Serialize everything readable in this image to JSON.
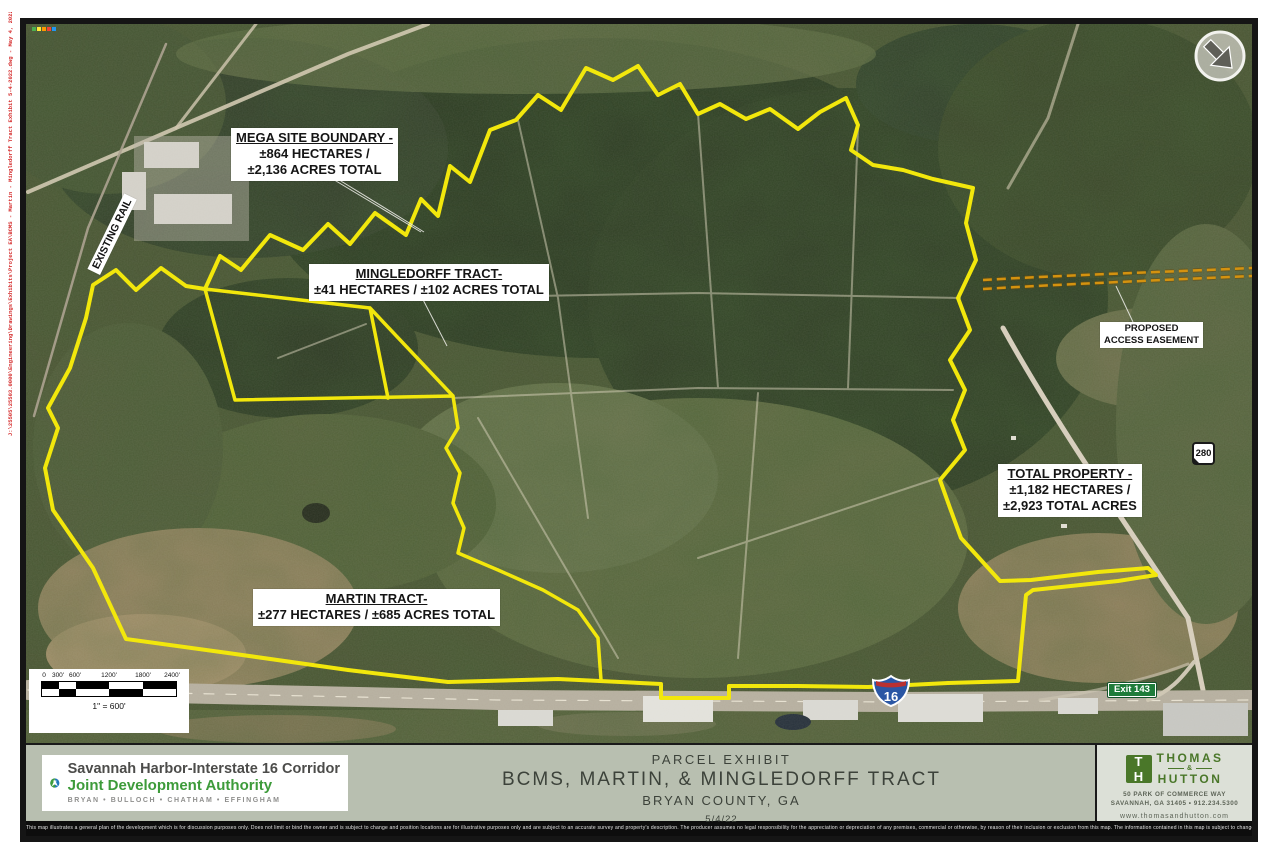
{
  "sheet": {
    "plot_stamp": "J:\\25505\\25503.0000\\Engineering\\Drawings\\Exhibits\\Project EA\\BCMS - Martin - Mingledorff Tract Exhibit 5-4-2022.dwg - May 4, 2022 - 2:36:06 PM"
  },
  "map": {
    "labels": {
      "mega_site": {
        "title": "MEGA SITE BOUNDARY -",
        "line1": "±864 HECTARES /",
        "line2": "±2,136 ACRES TOTAL"
      },
      "mingledorff": {
        "title": "MINGLEDORFF TRACT-",
        "line1": "±41 HECTARES / ±102 ACRES TOTAL"
      },
      "martin": {
        "title": "MARTIN TRACT-",
        "line1": "±277 HECTARES / ±685 ACRES TOTAL"
      },
      "total_property": {
        "title": "TOTAL PROPERTY -",
        "line1": "±1,182 HECTARES /",
        "line2": "±2,923 TOTAL ACRES"
      },
      "access_easement": {
        "line1": "PROPOSED",
        "line2": "ACCESS EASEMENT"
      },
      "existing_rail": "EXISTING RAIL"
    },
    "markers": {
      "interstate": "16",
      "state_route": "280",
      "exit_sign": "Exit 143"
    },
    "scale_bar": {
      "ticks": [
        "0",
        "300'",
        "600'",
        "1200'",
        "1800'",
        "2400'"
      ],
      "ratio": "1\" = 600'"
    },
    "colors": {
      "boundary_yellow": "#f2e70c",
      "easement_orange": "#d4920f"
    }
  },
  "title_block": {
    "project": {
      "type": "PARCEL EXHIBIT",
      "name": "BCMS, MARTIN, & MINGLEDORFF TRACT",
      "location": "BRYAN COUNTY, GA",
      "date": "5/4/22"
    },
    "authority": {
      "name_line1": "Savannah Harbor-Interstate 16 Corridor",
      "name_line2": "Joint Development Authority",
      "counties": "BRYAN  •  BULLOCH  •  CHATHAM  •  EFFINGHAM"
    },
    "firm": {
      "name_top": "THOMAS",
      "ampersand": "&",
      "name_bottom": "HUTTON",
      "address": "50 PARK OF COMMERCE WAY",
      "city_phone": "SAVANNAH, GA 31405  •  912.234.5300",
      "website": "www.thomasandhutton.com"
    }
  },
  "disclaimer": "This map illustrates a general plan of the development which is for discussion purposes only. Does not limit or bind the owner and is subject to change and position locations are for illustrative purposes only and are subject to an accurate survey and property's description. The producer assumes no legal responsibility for the appreciation or depreciation of any premises, commercial or otherwise, by reason of their inclusion or exclusion from this map. The information contained in this map is subject to change without notice and is for illustrative purposes only. Unit counts shown are approximate and may change. Values were provided by outside sources and have not been verified."
}
